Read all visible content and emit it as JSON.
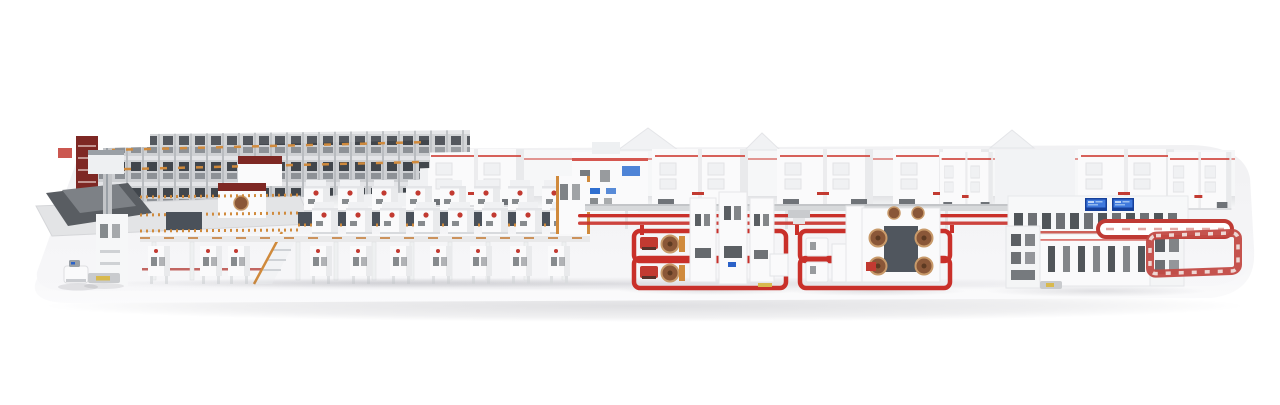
{
  "scene": {
    "alt": "Isometric 3D rendering of a complete corrugated board production line on a long white rounded platform: roll storage racks, wet-end mezzanine, elevated corrugator bridge with rows of white units, red safety-loop splicer zones with brown paper rolls, a dry-end machine with blue display screens, and red conveyor loops at the right end",
    "background": "#ffffff"
  },
  "colors": {
    "bg": "#ffffff",
    "platform-top": "#f1f1f3",
    "platform-front": "#e7e8eb",
    "platform-edge": "#dcdde0",
    "wall": "#f6f7f8",
    "machine-white": "#fafafb",
    "machine-shade": "#e9eaec",
    "panel-dark": "#4a515a",
    "slot-dark": "#565b60",
    "window-dark": "#33383d",
    "accent-red": "#c23a31",
    "pinstripe-red": "#d0453d",
    "loop-red": "#c9302a",
    "dark-red": "#7e2824",
    "scaffold-orange": "#d08a3c",
    "orange-deep": "#c1752c",
    "roll-brown": "#8a5738",
    "roll-rim": "#c89a6a",
    "screen-blue": "#3f79dd",
    "screen-blue-deep": "#16409a",
    "gray-light": "#ced0d3",
    "gray-mid": "#9aa0a6",
    "gray-dark": "#595d62",
    "track-gray": "#d7d9db",
    "yellow-accent": "#d8b94e"
  },
  "sections": {
    "left": [
      "roll-storage-racks",
      "dark-red-rack",
      "infeed-table",
      "mast-tower",
      "agv",
      "shuttle-pallet"
    ],
    "center": [
      "wet-end-mezzanine",
      "corrugator-bridge",
      "overhead-conveyor",
      "red-floor-track"
    ],
    "zones": [
      "splicer-zone-1",
      "splicer-zone-2"
    ],
    "right": [
      "dry-end-machine",
      "display-screens",
      "red-racetrack-loop",
      "red-frame-loop"
    ]
  }
}
